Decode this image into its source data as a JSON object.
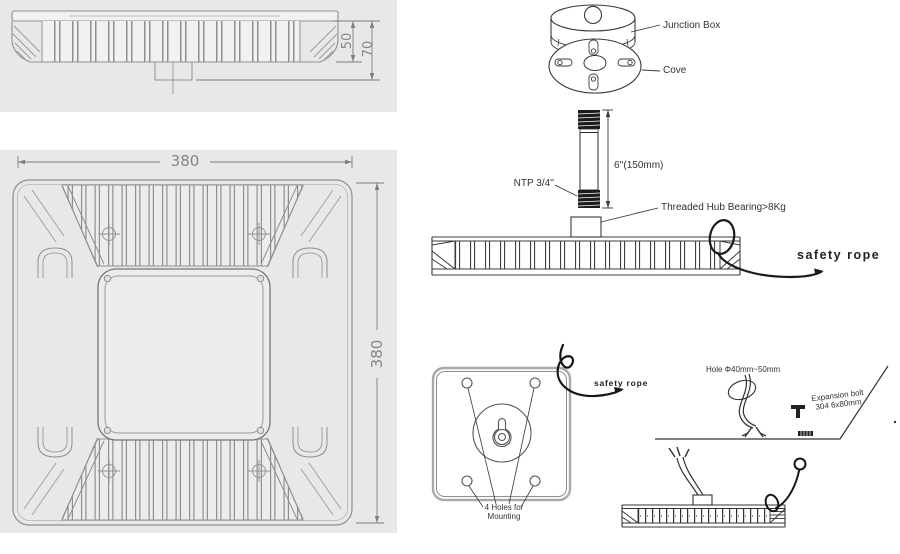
{
  "colors": {
    "panel_background": "#e8e8e7",
    "drawing_line_left": "#8f8f8f",
    "drawing_line_right": "#3a3a3a",
    "dimension_text": "#858585",
    "thread_fill": "#1c1c1c"
  },
  "side_view": {
    "dim_depth_inner": "50",
    "dim_depth_outer": "70"
  },
  "top_view": {
    "dim_width": "380",
    "dim_height": "380"
  },
  "junction_box_view": {
    "junction_box_label": "Junction Box",
    "cove_label": "Cove"
  },
  "pipe_view": {
    "thread_label": "NTP 3/4''",
    "length_label": "6''(150mm)"
  },
  "hub_view": {
    "hub_label": "Threaded Hub Bearing>8Kg",
    "safety_rope_label": "safety rope"
  },
  "plate_view": {
    "safety_rope_label": "safety rope",
    "holes_label_line1": "4 Holes for",
    "holes_label_line2": "Mounting"
  },
  "ceiling_view": {
    "hole_label": "Hole Φ40mm~50mm",
    "bolt_label_line1": "Expansion bolt",
    "bolt_label_line2": "304 6x80mm"
  }
}
